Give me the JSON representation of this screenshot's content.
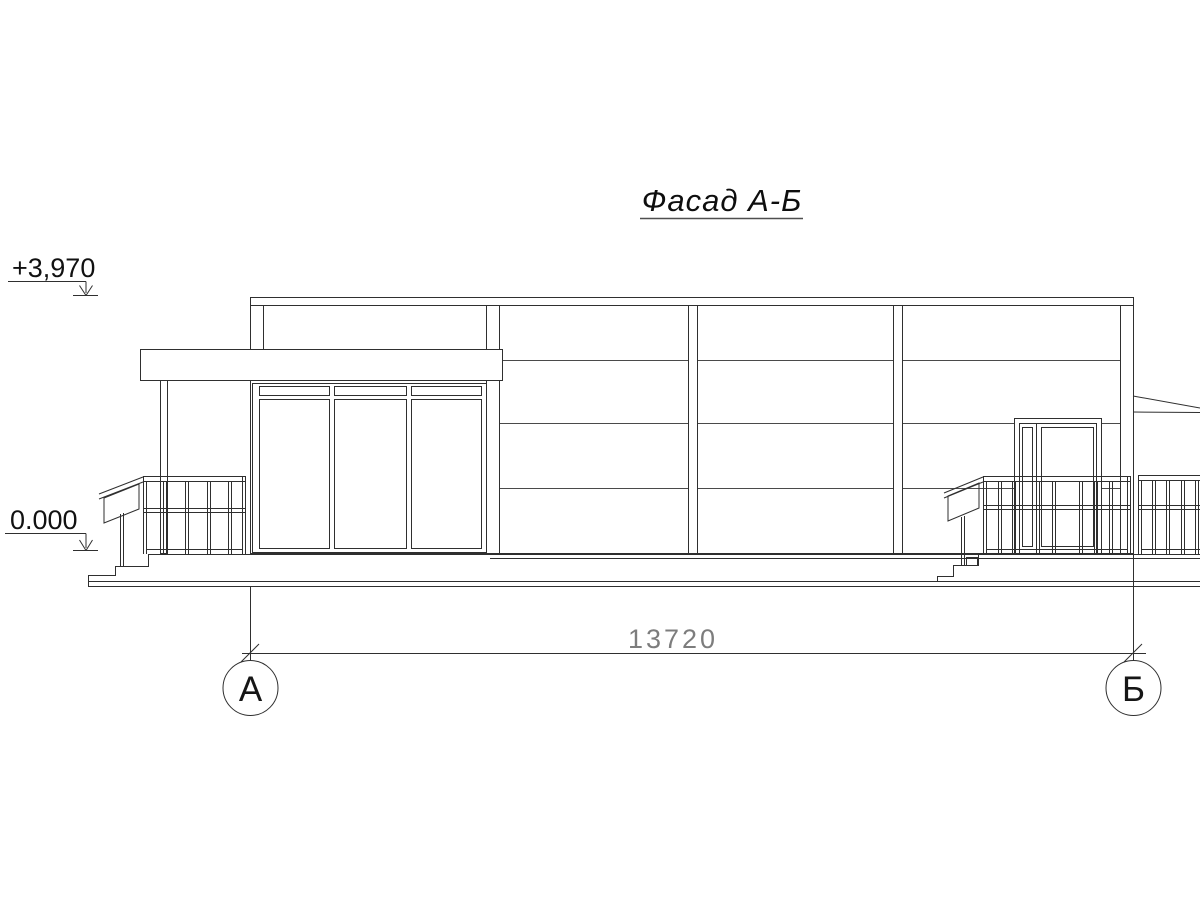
{
  "drawing": {
    "title": "Фасад А-Б",
    "type_note": "building facade elevation between axes A and B"
  },
  "levels": {
    "parapet": "+3,970",
    "ground": "0.000"
  },
  "dimension": {
    "overall": "13720"
  },
  "axes": {
    "left": "А",
    "right": "Б"
  },
  "colors": {
    "line": "#2f2f2f",
    "joint_line": "#4a4a4a",
    "dim_text": "#7d7d7d",
    "background": "#ffffff"
  }
}
